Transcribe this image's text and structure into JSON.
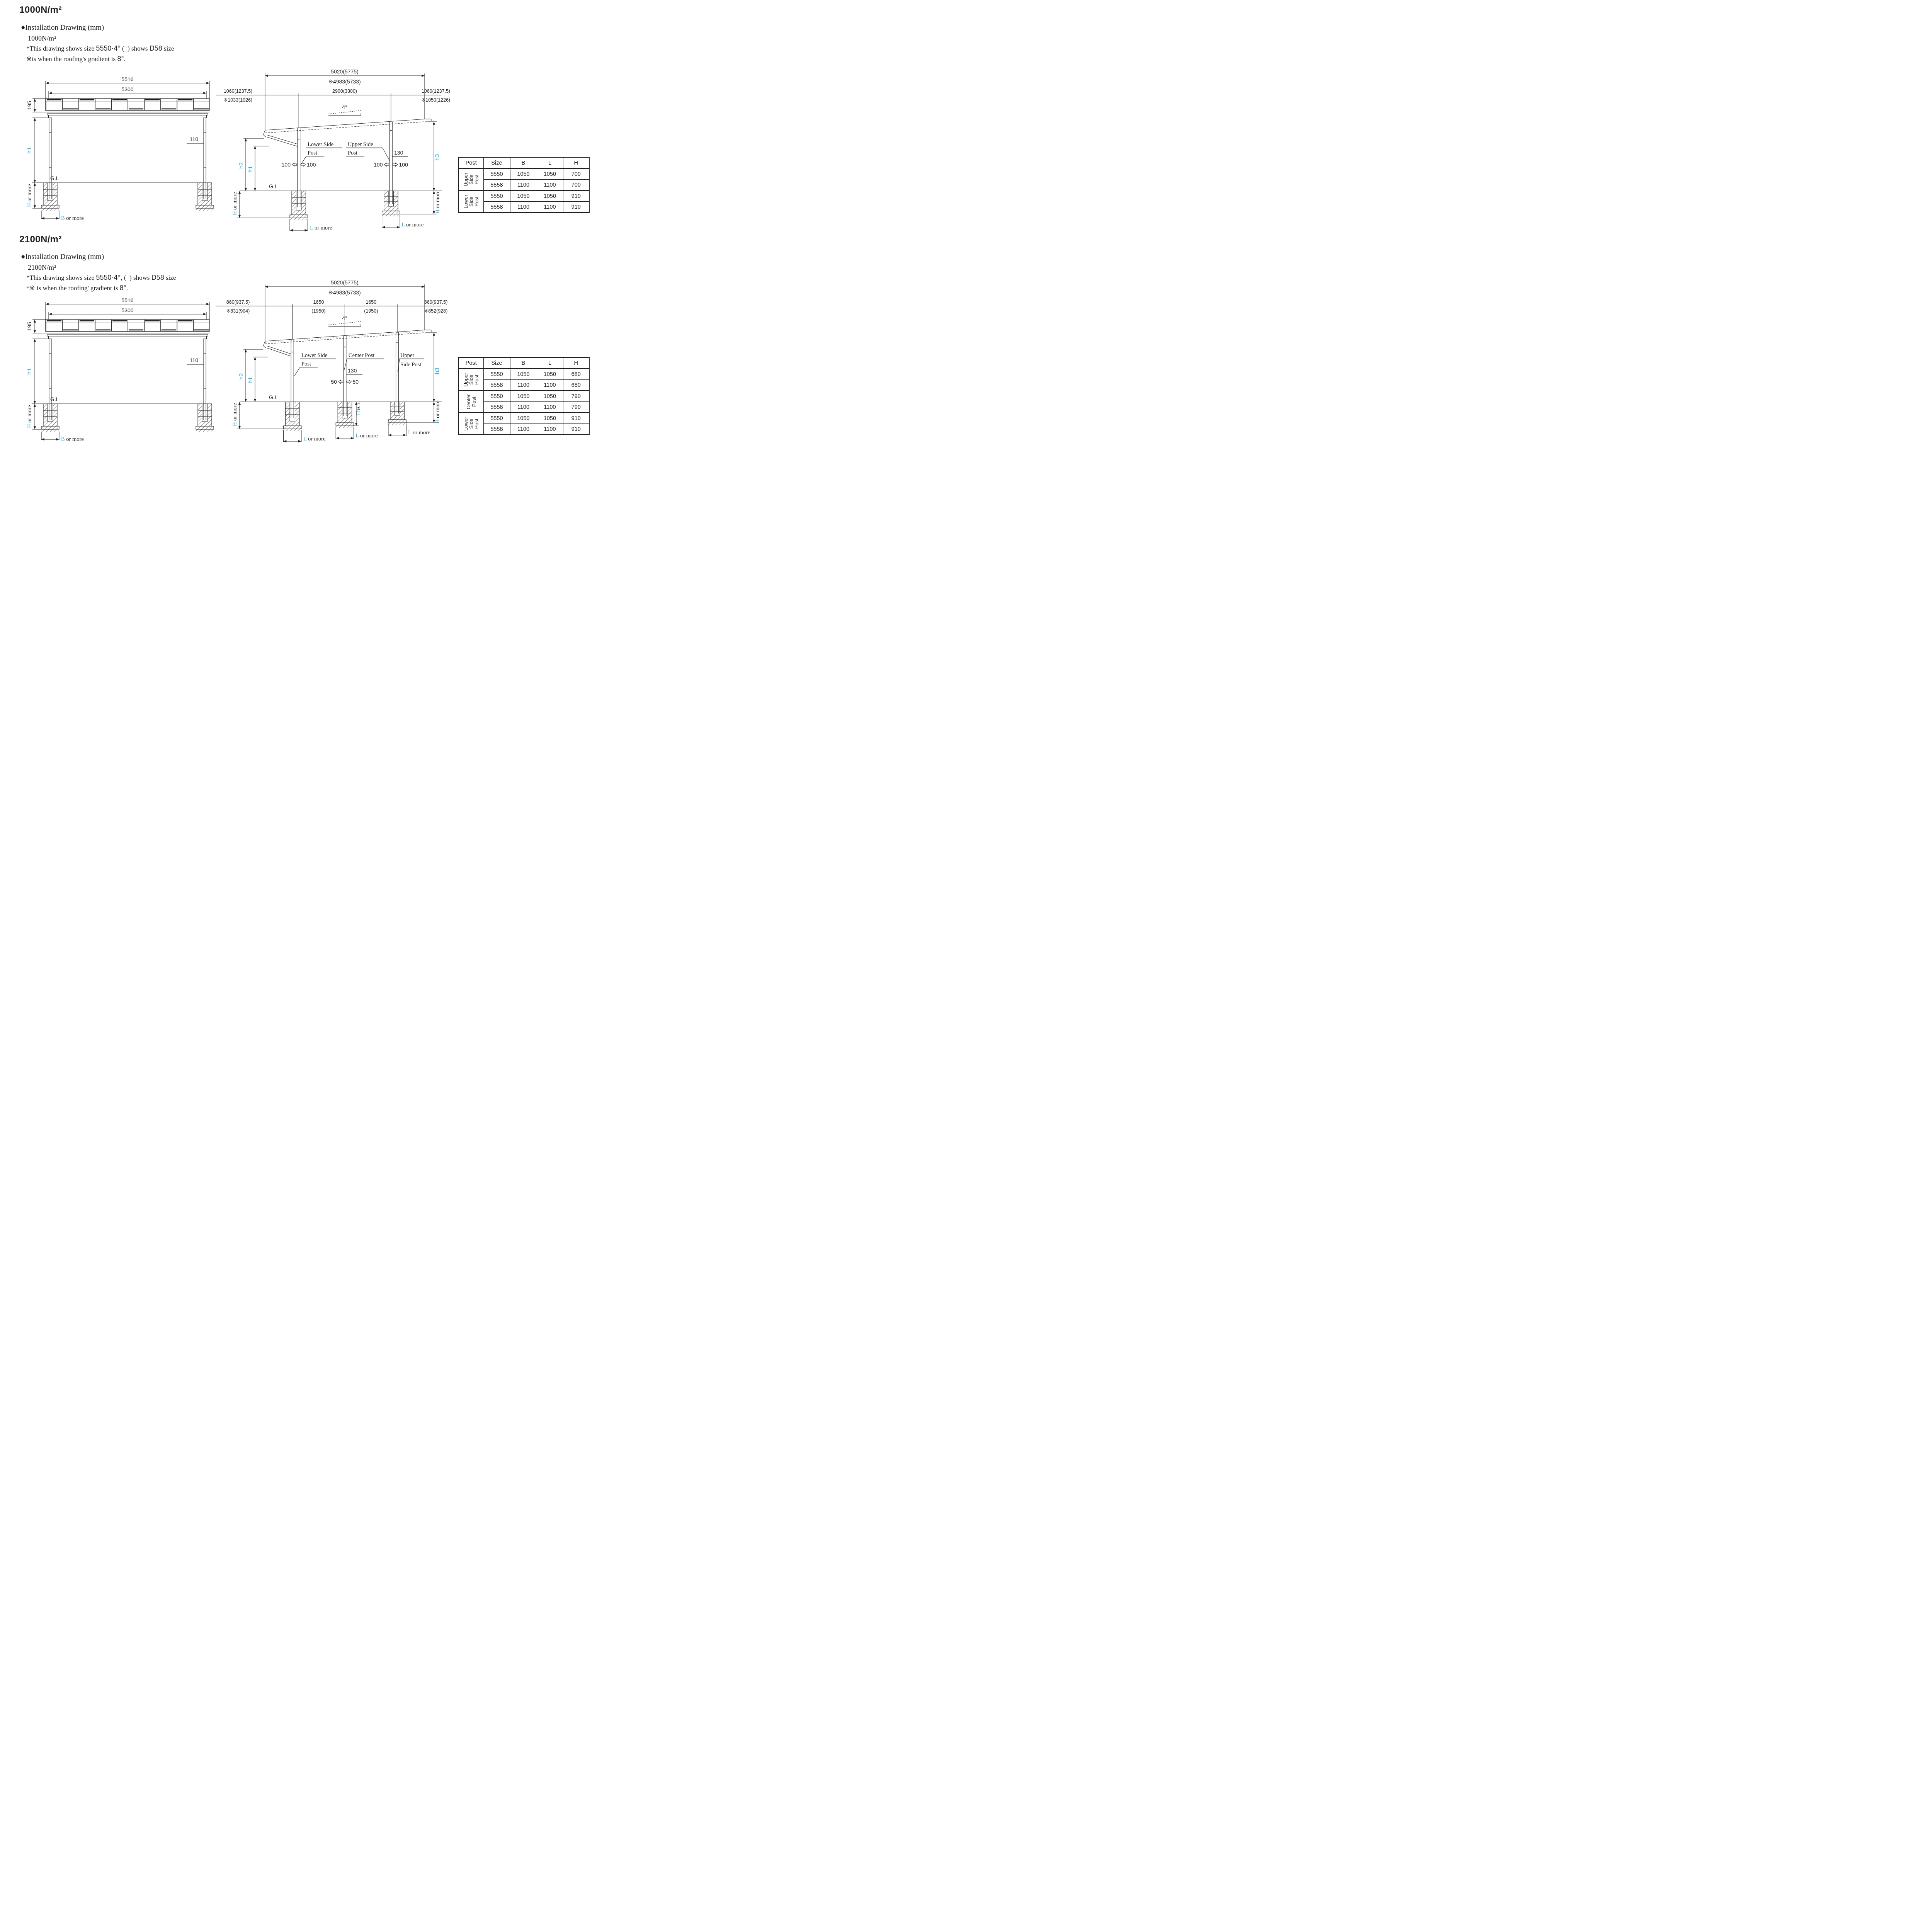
{
  "page": {
    "background": "#ffffff",
    "ink_color": "#231f20",
    "accent_color": "#29abe2"
  },
  "sections": [
    {
      "title": "1000N/m²",
      "heading": "●Installation Drawing (mm)",
      "sub_label": "1000N/m²",
      "note1": {
        "a": "*This drawing shows size ",
        "b": "5550·4°",
        "c": " (  ) shows ",
        "d": "D58",
        "e": " size"
      },
      "note2": {
        "a": "※is when the roofing's gradient is ",
        "b": "8°",
        "c": "."
      },
      "front": {
        "dim_outer": "5516",
        "dim_inner": "5300",
        "dim_roof_h": "195",
        "dim_post_w": "110",
        "h1": "h1",
        "gl": "G.L",
        "h_min": "H",
        "h_min_rest": " or more",
        "b_min": "B",
        "b_min_rest": " or more"
      },
      "side": {
        "dim_total": "5020(5775)",
        "dim_total_alt": "※4983(5733)",
        "dim_left": "1060(1237.5)",
        "dim_left_alt": "※1033(1026)",
        "dim_mid": "2900(3300)",
        "dim_right": "1060(1237.5)",
        "dim_right_alt": "※1050(1226)",
        "angle": "4°",
        "post_a_line1": "Lower Side",
        "post_a_line2": "Post",
        "post_b_line1": "Upper Side",
        "post_b_line2": "Post",
        "dim_130": "130",
        "dim_100": "100",
        "h2": "h2",
        "h1": "h1",
        "h3": "h3",
        "gl": "G.L",
        "h_min": "H",
        "h_min_rest": " or more",
        "l_min": "L",
        "l_min_rest": " or more"
      },
      "table": {
        "headers": [
          "Post",
          "Size",
          "B",
          "L",
          "H"
        ],
        "groups": [
          {
            "label": "Upper\nSide\nPost",
            "rows": [
              [
                "5550",
                "1050",
                "1050",
                "700"
              ],
              [
                "5558",
                "1100",
                "1100",
                "700"
              ]
            ]
          },
          {
            "label": "Lower\nSide\nPost",
            "rows": [
              [
                "5550",
                "1050",
                "1050",
                "910"
              ],
              [
                "5558",
                "1100",
                "1100",
                "910"
              ]
            ]
          }
        ]
      }
    },
    {
      "title": "2100N/m²",
      "heading": "●Installation Drawing (mm)",
      "sub_label": "2100N/m²",
      "note1": {
        "a": "*This drawing shows size ",
        "b": "5550·4°,",
        "c": " (  ) shows ",
        "d": "D58",
        "e": " size"
      },
      "note2": {
        "a": "*※ is when the roofing' gradient is ",
        "b": "8°",
        "c": "."
      },
      "front": {
        "dim_outer": "5516",
        "dim_inner": "5300",
        "dim_roof_h": "195",
        "dim_post_w": "110",
        "h1": "h1",
        "gl": "G.L",
        "h_min": "H",
        "h_min_rest": " or more",
        "b_min": "B",
        "b_min_rest": " or more"
      },
      "side": {
        "dim_total": "5020(5775)",
        "dim_total_alt": "※4983(5733)",
        "dim_left": "860(937.5)",
        "dim_left_alt": "※831(904)",
        "dim_mid1": "1650",
        "dim_mid1_alt": "(1950)",
        "dim_mid2": "1650",
        "dim_mid2_alt": "(1950)",
        "dim_right": "860(937.5)",
        "dim_right_alt": "※852(928)",
        "angle": "4°",
        "post_a_line1": "Lower Side",
        "post_a_line2": "Post",
        "post_b_label": "Center Post",
        "post_c_line1": "Upper",
        "post_c_line2": "Side Post",
        "dim_130": "130",
        "dim_50": "50",
        "h2": "h2",
        "h1": "h1",
        "h3": "h3",
        "gl": "G.L",
        "h_min": "H",
        "h_min_rest": " or more",
        "center_h_label": "H以上",
        "center_h_prefix": "H",
        "l_min": "L",
        "l_min_rest": " or more"
      },
      "table": {
        "headers": [
          "Post",
          "Size",
          "B",
          "L",
          "H"
        ],
        "groups": [
          {
            "label": "Upper\nSide\nPost",
            "rows": [
              [
                "5550",
                "1050",
                "1050",
                "680"
              ],
              [
                "5558",
                "1100",
                "1100",
                "680"
              ]
            ]
          },
          {
            "label": "Center\nPost",
            "rows": [
              [
                "5550",
                "1050",
                "1050",
                "790"
              ],
              [
                "5558",
                "1100",
                "1100",
                "790"
              ]
            ]
          },
          {
            "label": "Lower\nSide\nPost",
            "rows": [
              [
                "5550",
                "1050",
                "1050",
                "910"
              ],
              [
                "5558",
                "1100",
                "1100",
                "910"
              ]
            ]
          }
        ]
      }
    }
  ]
}
